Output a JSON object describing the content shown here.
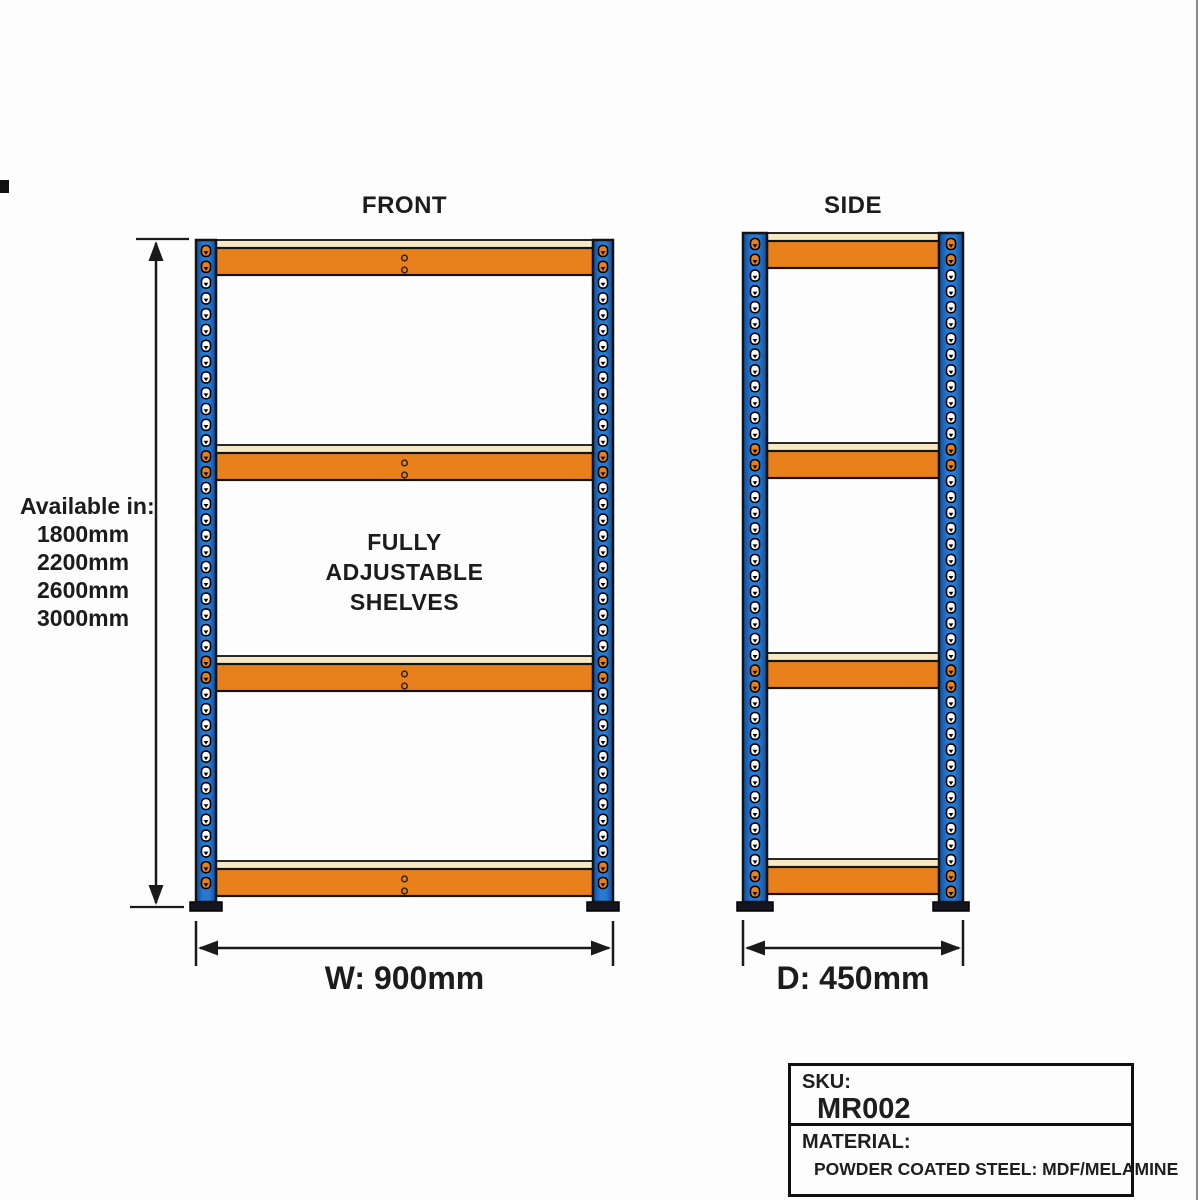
{
  "views": {
    "front_label": "FRONT",
    "side_label": "SIDE"
  },
  "annotations": {
    "available_title": "Available in:",
    "available_sizes": [
      "1800mm",
      "2200mm",
      "2600mm",
      "3000mm"
    ],
    "adjustable_lines": [
      "FULLY",
      "ADJUSTABLE",
      "SHELVES"
    ],
    "width_dimension": "W: 900mm",
    "depth_dimension": "D: 450mm"
  },
  "title_block": {
    "sku_label": "SKU:",
    "sku_value": "MR002",
    "material_label": "MATERIAL:",
    "material_value": "POWDER COATED STEEL: MDF/MELAMINE"
  },
  "colors": {
    "upright_blue_mid": "#2a79d0",
    "upright_blue_edge": "#0c4c9c",
    "beam_orange": "#e8811c",
    "shelf_cream": "#f6e9c4",
    "outline": "#131313",
    "foot_dark": "#15151f",
    "hole_white": "#ffffff",
    "dimension_line": "#1a1a1a"
  }
}
